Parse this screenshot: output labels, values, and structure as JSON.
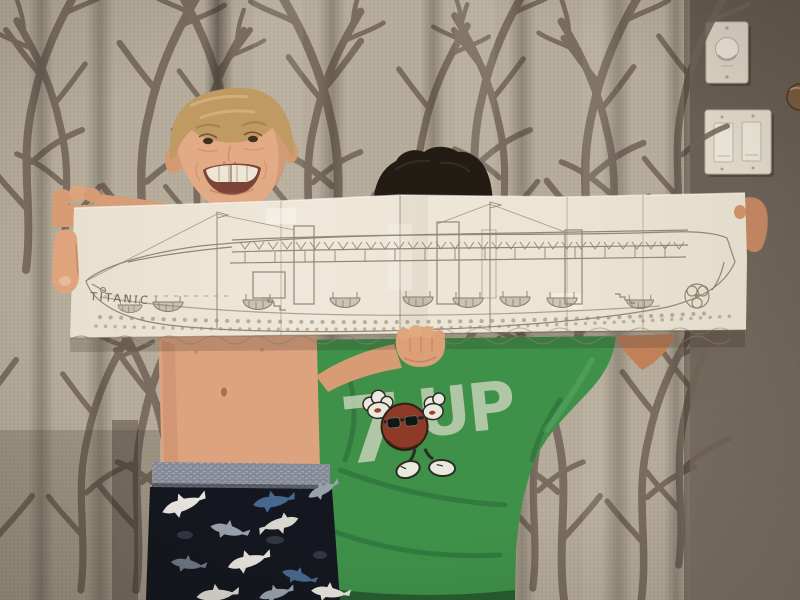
{
  "scene": {
    "description": "Two kids in a bedroom holding up a long panoramic pencil drawing of an ocean liner on taped-together paper",
    "left_child": "smiling blond shirtless boy in shark-print pajama pants",
    "right_child": "taller kid hidden behind the paper, dark hair peeking over the top, wearing a green 7UP t-shirt"
  },
  "drawing": {
    "ship_name": "TITANIC",
    "subject": "side view of ocean liner with funnels, masts, lifeboats, portholes, propeller and waves",
    "paper_color": "#ece4d4",
    "pencil_color": "#8a7d6a"
  },
  "shirt": {
    "logo_seven": "7",
    "logo_up": "UP",
    "mascot": "cool-spot with sunglasses, gloves and sneakers",
    "color": "#3f9049"
  },
  "room": {
    "curtain_base": "#b5ab9a",
    "curtain_branch": "#6f6255",
    "wall_color": "#6b6156",
    "switches": [
      "dimmer-knob-plate",
      "double-rocker-plate"
    ],
    "door_hardware": "bronze knob at right edge"
  },
  "palette": {
    "boy_skin": "#e0a77f",
    "boy_hair": "#bf9a63",
    "dark_hair": "#221c15",
    "pants": "#14171f",
    "waistband": "#848996"
  }
}
